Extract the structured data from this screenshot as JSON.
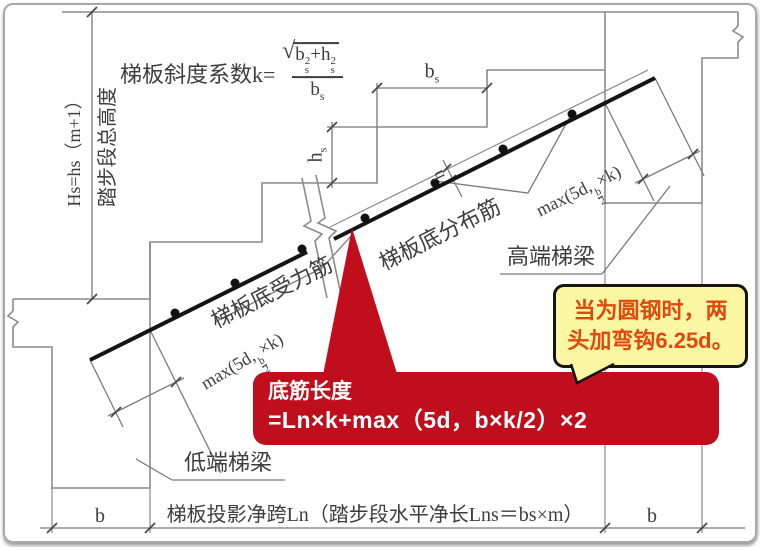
{
  "drawing": {
    "formula": {
      "prefix": "梯板斜度系数k=",
      "sqrt_sign": "√",
      "num_b": "b",
      "num_plus": "+h",
      "sub_s": "s",
      "sup_2": "2",
      "den_b": "b",
      "den_sub": "s"
    },
    "left_dim": {
      "line1": "Hs=hs（m+1）",
      "line2": "踏步段总高度"
    },
    "dims": {
      "bs_main": "b",
      "bs_sub": "s",
      "hs_main": "h",
      "hs_sub": "s",
      "h": "h",
      "b_left": "b",
      "b_right": "b",
      "bottom_span": "梯板投影净跨Ln（踏步段水平净长Lns＝bs×m）"
    },
    "max_label": {
      "pre": "max(5d,",
      "fnum": "b",
      "fden": "2",
      "post": "×k)"
    },
    "labels": {
      "bottom_main_bar": "梯板底受力筋",
      "bottom_dist_bar": "梯板底分布筋",
      "high_beam": "高端梯梁",
      "low_beam": "低端梯梁"
    },
    "red_callout": {
      "title": "底筋长度",
      "formula": "=Ln×k+max（5d，b×k/2）×2",
      "bg_color": "#c10e1c",
      "text_color": "#ffffff"
    },
    "yellow_callout": {
      "line1": "当为圆钢时，两",
      "line2": "头加弯钩6.25d。",
      "bg_color": "#fbf6a2",
      "text_color": "#e2470f"
    }
  }
}
